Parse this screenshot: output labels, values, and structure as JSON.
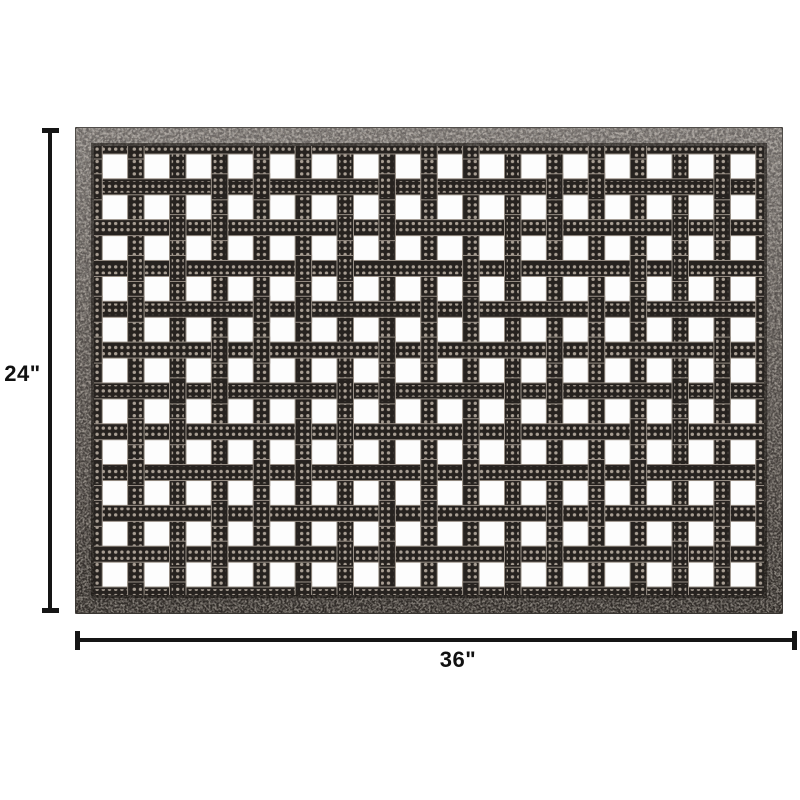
{
  "page": {
    "background_color": "#ffffff"
  },
  "mat": {
    "name": "basket-weave-rubber-doormat",
    "grid": {
      "cols": 16,
      "rows": 11
    },
    "colors": {
      "frame_light": "#918d8a",
      "frame_mid": "#6b6662",
      "frame_dark": "#332f2b",
      "speckle_light": "#cdc6bd",
      "speckle_dark": "#211d1a",
      "bar": "#26221f",
      "dot": "#a99f94",
      "ridge": "#978e85",
      "hole": "#fdfdfd"
    }
  },
  "annotations": {
    "line_color": "#151515",
    "height": {
      "label": "24\"",
      "value": 24,
      "unit": "inches"
    },
    "width": {
      "label": "36\"",
      "value": 36,
      "unit": "inches"
    }
  }
}
